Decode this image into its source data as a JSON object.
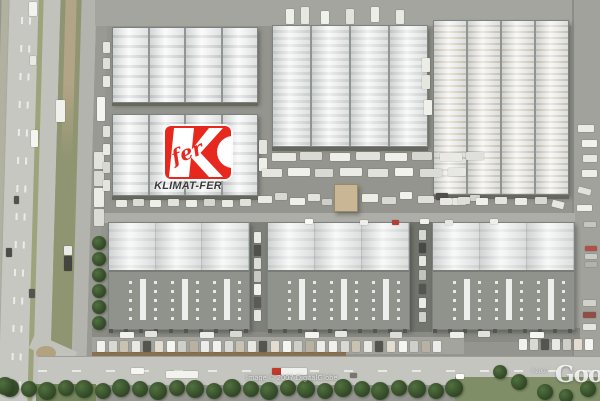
{
  "watermarks": {
    "imagery_credit": "Image © 2007 DigitalGlobe",
    "copyright_small": "©2007",
    "provider_logo": "Google"
  },
  "marker": {
    "script_text": "fer",
    "label": "KLIMAT-FER"
  },
  "palette": {
    "logo_red": "#e6281e",
    "label_text": "#3b3b3b",
    "roof_white": "#f3f4f3",
    "roof_rib": "#d7dad9",
    "roof_rib_tan": "#d8c8b0",
    "asphalt": "#95958f",
    "road": "#c6c6c0",
    "vegetation": "#8f9570",
    "tree_dark": "#2f4526",
    "grass": "#7f8e66"
  },
  "scene": {
    "vehicles": [
      [
        29,
        2,
        8,
        14,
        "#f2f2ee"
      ],
      [
        30,
        56,
        6,
        9,
        "#e9e9e5"
      ],
      [
        31,
        130,
        7,
        17,
        "#f4f4f0"
      ],
      [
        6,
        248,
        6,
        9,
        "#4c4c48"
      ],
      [
        29,
        289,
        6,
        9,
        "#55554f"
      ],
      [
        14,
        196,
        5,
        8,
        "#52524e"
      ],
      [
        64,
        246,
        8,
        9,
        "#eceae6"
      ],
      [
        64,
        256,
        8,
        15,
        "#45453f"
      ],
      [
        56,
        100,
        9,
        22,
        "#f0f0ec"
      ],
      [
        97,
        97,
        8,
        24,
        "#f4f4f0"
      ],
      [
        94,
        152,
        10,
        17,
        "#e3e3dd"
      ],
      [
        94,
        171,
        10,
        15,
        "#d9d9d3"
      ],
      [
        94,
        188,
        10,
        19,
        "#ecece6"
      ],
      [
        94,
        209,
        10,
        17,
        "#dcdcd6"
      ],
      [
        103,
        42,
        7,
        11,
        "#e6e6e0"
      ],
      [
        103,
        58,
        7,
        11,
        "#dfdfd9"
      ],
      [
        103,
        76,
        7,
        11,
        "#e9e9e3"
      ],
      [
        103,
        126,
        7,
        11,
        "#e2e2dc"
      ],
      [
        103,
        144,
        7,
        11,
        "#ebebe5"
      ],
      [
        103,
        162,
        7,
        11,
        "#d8d8d2"
      ],
      [
        103,
        180,
        7,
        11,
        "#e5e5df"
      ],
      [
        286,
        9,
        8,
        15,
        "#efefe9"
      ],
      [
        301,
        7,
        8,
        17,
        "#e7e7e1"
      ],
      [
        321,
        11,
        8,
        13,
        "#f1f1eb"
      ],
      [
        346,
        9,
        8,
        15,
        "#e3e3dd"
      ],
      [
        371,
        7,
        8,
        15,
        "#edede7"
      ],
      [
        396,
        10,
        8,
        14,
        "#e9e9e3"
      ],
      [
        259,
        140,
        8,
        14,
        "#e4e4de"
      ],
      [
        259,
        158,
        8,
        13,
        "#efefe9"
      ],
      [
        422,
        58,
        8,
        14,
        "#ecece6"
      ],
      [
        422,
        75,
        8,
        14,
        "#e6e6e0"
      ],
      [
        424,
        100,
        8,
        15,
        "#f0f0ea"
      ],
      [
        578,
        125,
        16,
        7,
        "#ebebe5"
      ],
      [
        582,
        140,
        15,
        7,
        "#f1f1ed"
      ],
      [
        583,
        155,
        14,
        7,
        "#e8e8e2"
      ],
      [
        582,
        170,
        15,
        7,
        "#eeeee8"
      ],
      [
        578,
        188,
        13,
        6,
        "#e2e2dc",
        15
      ],
      [
        577,
        205,
        15,
        6,
        "#f0f0ea"
      ],
      [
        584,
        222,
        12,
        5,
        "#c6c6c0"
      ],
      [
        585,
        246,
        12,
        5,
        "#b05048"
      ],
      [
        585,
        254,
        12,
        5,
        "#caccc6"
      ],
      [
        585,
        262,
        12,
        5,
        "#b0b2ac"
      ],
      [
        583,
        300,
        13,
        6,
        "#d2d2cc"
      ],
      [
        583,
        312,
        13,
        6,
        "#8f4f46"
      ],
      [
        583,
        324,
        13,
        6,
        "#e6e6e0"
      ],
      [
        272,
        153,
        24,
        8,
        "#e9e9e4"
      ],
      [
        300,
        152,
        22,
        8,
        "#dadad4"
      ],
      [
        330,
        153,
        20,
        8,
        "#efefe9"
      ],
      [
        356,
        152,
        24,
        8,
        "#e2e2dc"
      ],
      [
        385,
        153,
        22,
        8,
        "#f0f0ea"
      ],
      [
        412,
        152,
        20,
        8,
        "#d6d6d0"
      ],
      [
        440,
        153,
        22,
        8,
        "#eaeae4"
      ],
      [
        466,
        152,
        18,
        8,
        "#e0e0da"
      ],
      [
        262,
        169,
        20,
        8,
        "#e6e6e0"
      ],
      [
        288,
        168,
        22,
        8,
        "#f1f1eb"
      ],
      [
        315,
        169,
        18,
        8,
        "#d9d9d3"
      ],
      [
        340,
        168,
        22,
        8,
        "#ecece6"
      ],
      [
        368,
        169,
        20,
        8,
        "#e2e2dc"
      ],
      [
        395,
        168,
        18,
        8,
        "#f3f3ed"
      ],
      [
        420,
        169,
        22,
        8,
        "#dcdcd6"
      ],
      [
        448,
        168,
        18,
        8,
        "#e8e8e2"
      ],
      [
        258,
        196,
        14,
        7,
        "#eceae4"
      ],
      [
        275,
        193,
        12,
        7,
        "#d8d8d2"
      ],
      [
        290,
        198,
        15,
        7,
        "#f0f0ea"
      ],
      [
        308,
        194,
        12,
        7,
        "#e4e4de"
      ],
      [
        322,
        199,
        10,
        6,
        "#cfcfc9"
      ],
      [
        362,
        194,
        16,
        8,
        "#edede7"
      ],
      [
        382,
        197,
        14,
        7,
        "#dadad4"
      ],
      [
        400,
        192,
        12,
        7,
        "#f2f2ec"
      ],
      [
        418,
        196,
        16,
        7,
        "#e0e0da"
      ],
      [
        436,
        193,
        12,
        7,
        "#504f4a"
      ],
      [
        452,
        198,
        14,
        7,
        "#e8e8e2"
      ],
      [
        470,
        195,
        10,
        6,
        "#d4d4ce"
      ],
      [
        116,
        200,
        11,
        7,
        "#e9e9e3"
      ],
      [
        133,
        199,
        11,
        7,
        "#dcdcd6"
      ],
      [
        150,
        200,
        11,
        7,
        "#f0f0ea"
      ],
      [
        168,
        199,
        11,
        7,
        "#e3e3dd"
      ],
      [
        186,
        200,
        11,
        7,
        "#eeeee8"
      ],
      [
        204,
        199,
        11,
        7,
        "#d7d7d1"
      ],
      [
        222,
        200,
        11,
        7,
        "#ebebe5"
      ],
      [
        240,
        199,
        11,
        7,
        "#e1e1db"
      ],
      [
        440,
        198,
        12,
        7,
        "#eae8e2"
      ],
      [
        458,
        197,
        12,
        7,
        "#dfdfd9"
      ],
      [
        476,
        198,
        12,
        7,
        "#f1f1eb"
      ],
      [
        495,
        197,
        12,
        7,
        "#e5e5df"
      ],
      [
        515,
        198,
        12,
        7,
        "#ecece6"
      ],
      [
        535,
        197,
        12,
        7,
        "#d9d9d3"
      ],
      [
        552,
        201,
        12,
        7,
        "#e7e7e1",
        15
      ],
      [
        305,
        219,
        8,
        5,
        "#fafaf6"
      ],
      [
        360,
        220,
        8,
        5,
        "#eeeeea"
      ],
      [
        392,
        220,
        7,
        5,
        "#b04038"
      ],
      [
        420,
        219,
        9,
        5,
        "#f2f2ee"
      ],
      [
        445,
        220,
        8,
        5,
        "#e6e6e2"
      ],
      [
        490,
        219,
        8,
        5,
        "#efefe9"
      ],
      [
        254,
        232,
        7,
        11,
        "#e8e8e4"
      ],
      [
        254,
        245,
        7,
        11,
        "#50504c"
      ],
      [
        254,
        258,
        7,
        11,
        "#dcdcd8"
      ],
      [
        254,
        271,
        7,
        11,
        "#c8c8c2"
      ],
      [
        254,
        284,
        7,
        11,
        "#f0f0ec"
      ],
      [
        254,
        297,
        7,
        11,
        "#5a5a56"
      ],
      [
        254,
        310,
        7,
        11,
        "#e4e4e0"
      ],
      [
        419,
        230,
        7,
        10,
        "#d8d8d2"
      ],
      [
        419,
        243,
        7,
        10,
        "#484844"
      ],
      [
        419,
        256,
        7,
        10,
        "#e6e6e0"
      ],
      [
        419,
        270,
        7,
        10,
        "#c2c2bc"
      ],
      [
        419,
        284,
        7,
        10,
        "#555550"
      ],
      [
        419,
        298,
        7,
        10,
        "#eaeae6"
      ],
      [
        419,
        312,
        7,
        10,
        "#d0d0ca"
      ],
      [
        120,
        332,
        14,
        6,
        "#f0f0ec"
      ],
      [
        145,
        331,
        12,
        6,
        "#e2e2de"
      ],
      [
        200,
        332,
        14,
        6,
        "#ecece8"
      ],
      [
        230,
        331,
        12,
        6,
        "#d8d8d4"
      ],
      [
        305,
        332,
        14,
        6,
        "#f2f2ee"
      ],
      [
        335,
        331,
        12,
        6,
        "#e6e6e2"
      ],
      [
        390,
        332,
        12,
        6,
        "#dcdcd8"
      ],
      [
        450,
        332,
        14,
        6,
        "#eeeeea"
      ],
      [
        478,
        331,
        12,
        6,
        "#e0e0dc"
      ],
      [
        530,
        332,
        14,
        6,
        "#f4f4f0"
      ],
      [
        131,
        368,
        13,
        6,
        "#f6f6f2"
      ],
      [
        166,
        371,
        32,
        7,
        "#f2f2ee"
      ],
      [
        272,
        368,
        9,
        7,
        "#c0392b"
      ],
      [
        281,
        368,
        26,
        7,
        "#f0f0ec"
      ],
      [
        350,
        373,
        7,
        5,
        "#76766f"
      ],
      [
        456,
        374,
        8,
        5,
        "#fdfdfb"
      ]
    ],
    "vehicle_rows": [
      {
        "x0": 97,
        "y": 341,
        "count": 30,
        "step": 11.6,
        "w": 8,
        "h": 11,
        "palette": [
          "#f1f1ed",
          "#d9d9d3",
          "#c9c2b2",
          "#e8e8e4",
          "#55554f",
          "#e3ddd1",
          "#f5f5f1",
          "#cfcfc9",
          "#b9b2a2",
          "#ececea"
        ]
      },
      {
        "x0": 519,
        "y": 339,
        "count": 7,
        "step": 11,
        "w": 8,
        "h": 11,
        "palette": [
          "#f1f1ed",
          "#d9d9d3",
          "#55554f",
          "#e8e8e4",
          "#cfcfc9",
          "#e3ddd1",
          "#f5f5f1"
        ]
      }
    ],
    "trees": {
      "row": {
        "x0": 10,
        "y": 389,
        "count": 25,
        "step": 18.5,
        "r": 9
      },
      "extra": [
        [
          99,
          243,
          7
        ],
        [
          99,
          259,
          7
        ],
        [
          99,
          275,
          7
        ],
        [
          99,
          291,
          7
        ],
        [
          99,
          307,
          7
        ],
        [
          99,
          323,
          7
        ],
        [
          500,
          372,
          7
        ],
        [
          519,
          382,
          8
        ],
        [
          545,
          392,
          8
        ],
        [
          566,
          396,
          7
        ],
        [
          588,
          389,
          8
        ],
        [
          5,
          386,
          9
        ]
      ]
    }
  }
}
